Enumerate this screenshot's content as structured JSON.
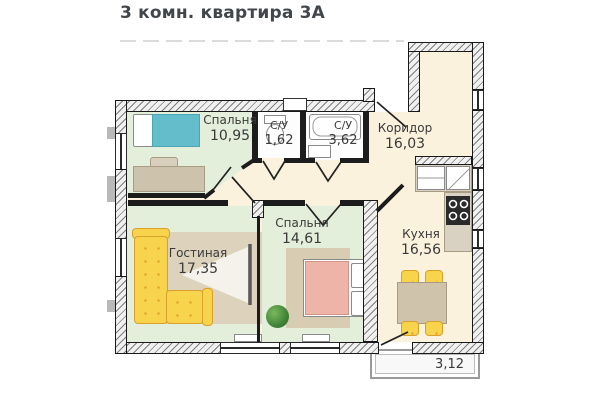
{
  "title": "3 комн. квартира 3А",
  "rooms": {
    "bedroom1": {
      "name": "Спальня",
      "area": "10,95"
    },
    "bathroom1": {
      "name": "С/У",
      "area": "1,62"
    },
    "bathroom2": {
      "name": "С/У",
      "area": "3,62"
    },
    "corridor": {
      "name": "Коридор",
      "area": "16,03"
    },
    "kitchen": {
      "name": "Кухня",
      "area": "16,56"
    },
    "living_room": {
      "name": "Гостиная",
      "area": "17,35"
    },
    "bedroom2": {
      "name": "Спальня",
      "area": "14,61"
    },
    "balcony": {
      "area": "3,12"
    }
  },
  "colors": {
    "room_floor": "#e3efdb",
    "hall_floor": "#fbf2de",
    "wall": "#1c1c1c",
    "sofa_yellow": "#f8d44c",
    "bed1_teal": "#63bdcb",
    "bed2_pink": "#eeb4a8"
  }
}
